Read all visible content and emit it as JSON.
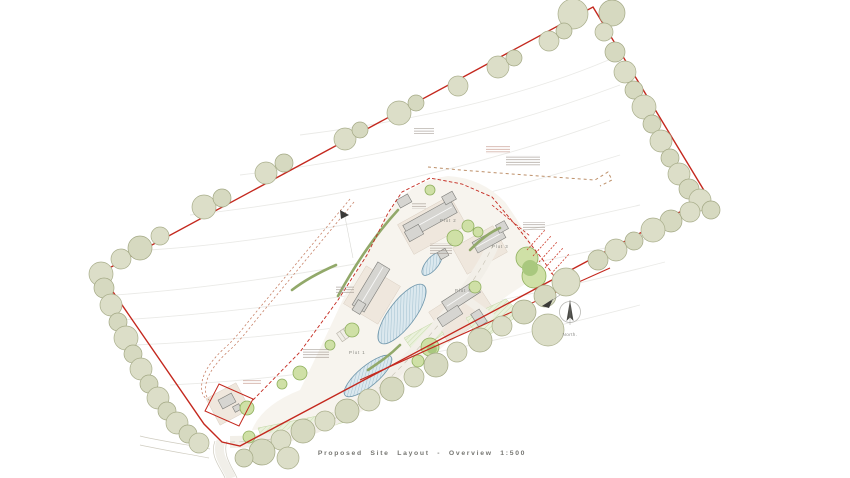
{
  "drawing": {
    "title": "Proposed Site Layout - Overview 1:500",
    "scale": "1:500",
    "north_label": "North.",
    "plots": [
      {
        "label": "Plot 1"
      },
      {
        "label": "Plot 2"
      },
      {
        "label": "Plot 3"
      },
      {
        "label": "Plot 4"
      }
    ],
    "colors": {
      "site_boundary_red": "#c4281e",
      "boundary_tree_sage": "#dcdec8",
      "inner_tree_green": "#cfe0a6",
      "water_blue": "#dbe8ee",
      "road_beige": "#f2efe8",
      "annotation_gray": "#a39a92",
      "annotation_red": "#c69a8e",
      "track_dashed_brown": "#c8846a"
    }
  }
}
